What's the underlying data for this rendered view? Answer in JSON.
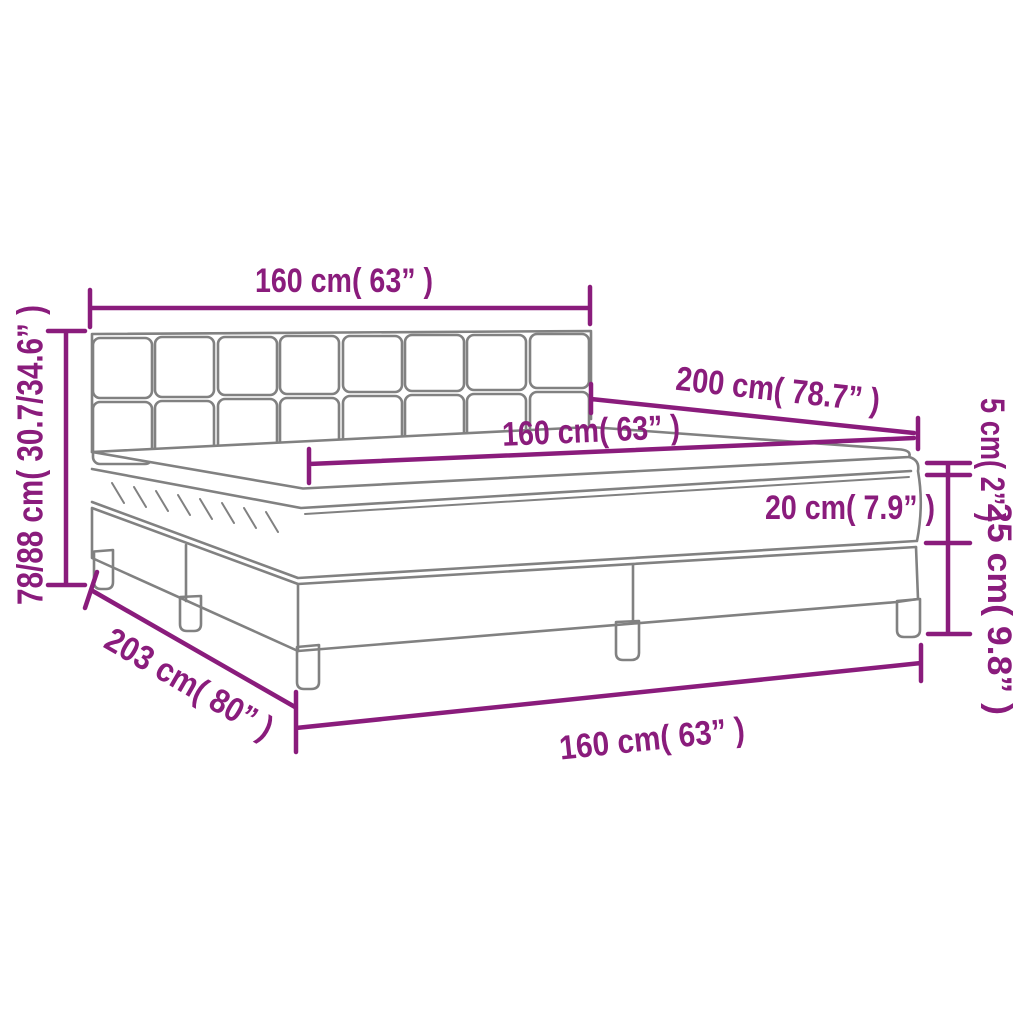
{
  "title": "Box spring bed with mattress and topper — dimension diagram",
  "colors": {
    "dimension": "#8A1C7C",
    "outline": "#818181",
    "background": "#FFFFFF"
  },
  "dimensions": {
    "headboard_width": "160 cm( 63” )",
    "bed_length": "200 cm( 78.7” )",
    "mattress_width": "160 cm( 63” )",
    "mattress_height": "20 cm( 7.9” )",
    "topper_height": "5 cm( 2” )",
    "base_height": "25 cm( 9.8” )",
    "total_height": "78/88 cm( 30.7/34.6” )",
    "base_length": "203 cm( 80” )",
    "base_width": "160 cm( 63” )"
  }
}
